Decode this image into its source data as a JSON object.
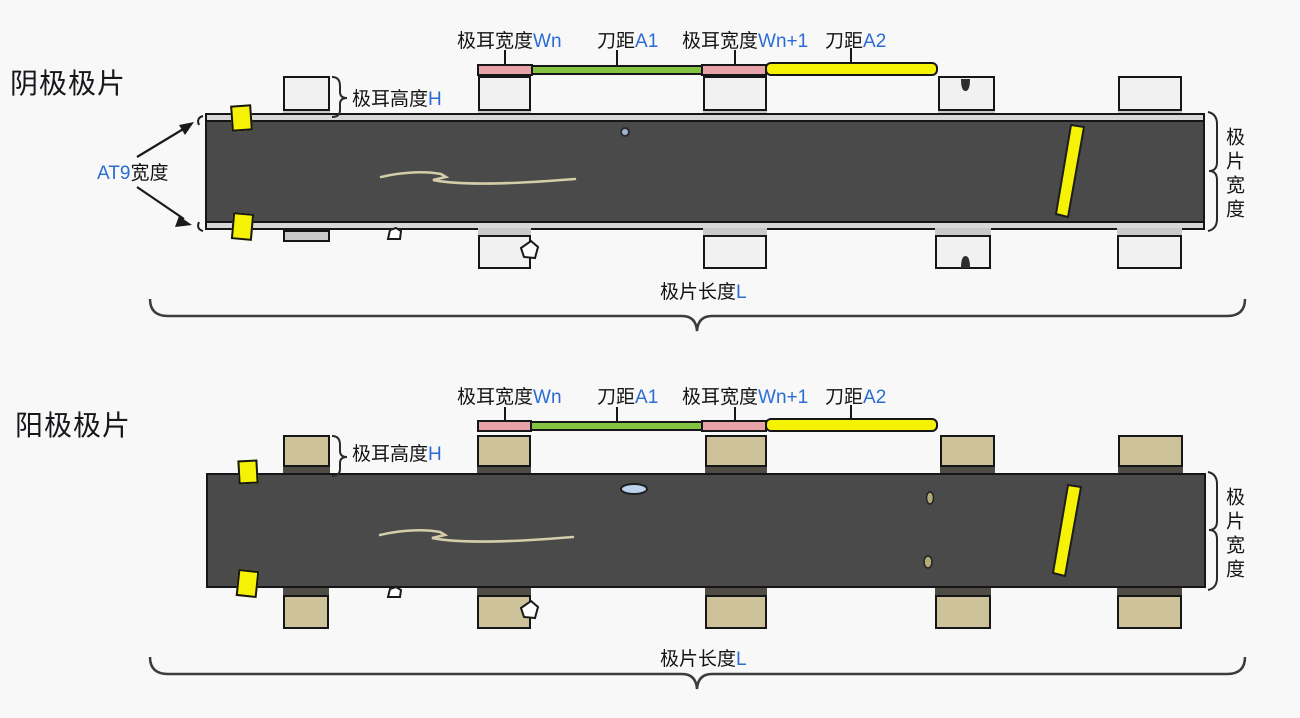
{
  "diagrams": [
    {
      "title": "阴极极片",
      "tab_width_n": {
        "prefix": "极耳宽度",
        "suffix": "Wn"
      },
      "blade_a1": {
        "prefix": "刀距",
        "suffix": "A1"
      },
      "tab_width_n1": {
        "prefix": "极耳宽度",
        "suffix": "Wn+1"
      },
      "blade_a2": {
        "prefix": "刀距",
        "suffix": "A2"
      },
      "tab_height": {
        "prefix": "极耳高度",
        "suffix": "H"
      },
      "at9_width": {
        "accent": "AT9",
        "rest": "宽度"
      },
      "sheet_width": "极片宽度",
      "sheet_length": {
        "prefix": "极片长度",
        "suffix": "L"
      }
    },
    {
      "title": "阳极极片",
      "tab_width_n": {
        "prefix": "极耳宽度",
        "suffix": "Wn"
      },
      "blade_a1": {
        "prefix": "刀距",
        "suffix": "A1"
      },
      "tab_width_n1": {
        "prefix": "极耳宽度",
        "suffix": "Wn+1"
      },
      "blade_a2": {
        "prefix": "刀距",
        "suffix": "A2"
      },
      "tab_height": {
        "prefix": "极耳高度",
        "suffix": "H"
      },
      "sheet_width": "极片宽度",
      "sheet_length": {
        "prefix": "极片长度",
        "suffix": "L"
      }
    }
  ],
  "colors": {
    "background": "#f8f8f8",
    "accent_text_blue": "#2b6cd4",
    "strip_dark": "#4a4a4a",
    "tab_body_gray": "#f1f1f1",
    "tab_band_gray": "#c9c9c9",
    "tab_body_tan": "#cec29b",
    "tab_band_dark": "#4e4c45",
    "bar_pink": "#e7a3a8",
    "bar_green": "#84c341",
    "bar_yellow": "#f6f205",
    "defect_mark_yellow": "#f6f205",
    "bubble_blue": "#bdd2ec",
    "scratch_tan": "#d5cdaa"
  }
}
